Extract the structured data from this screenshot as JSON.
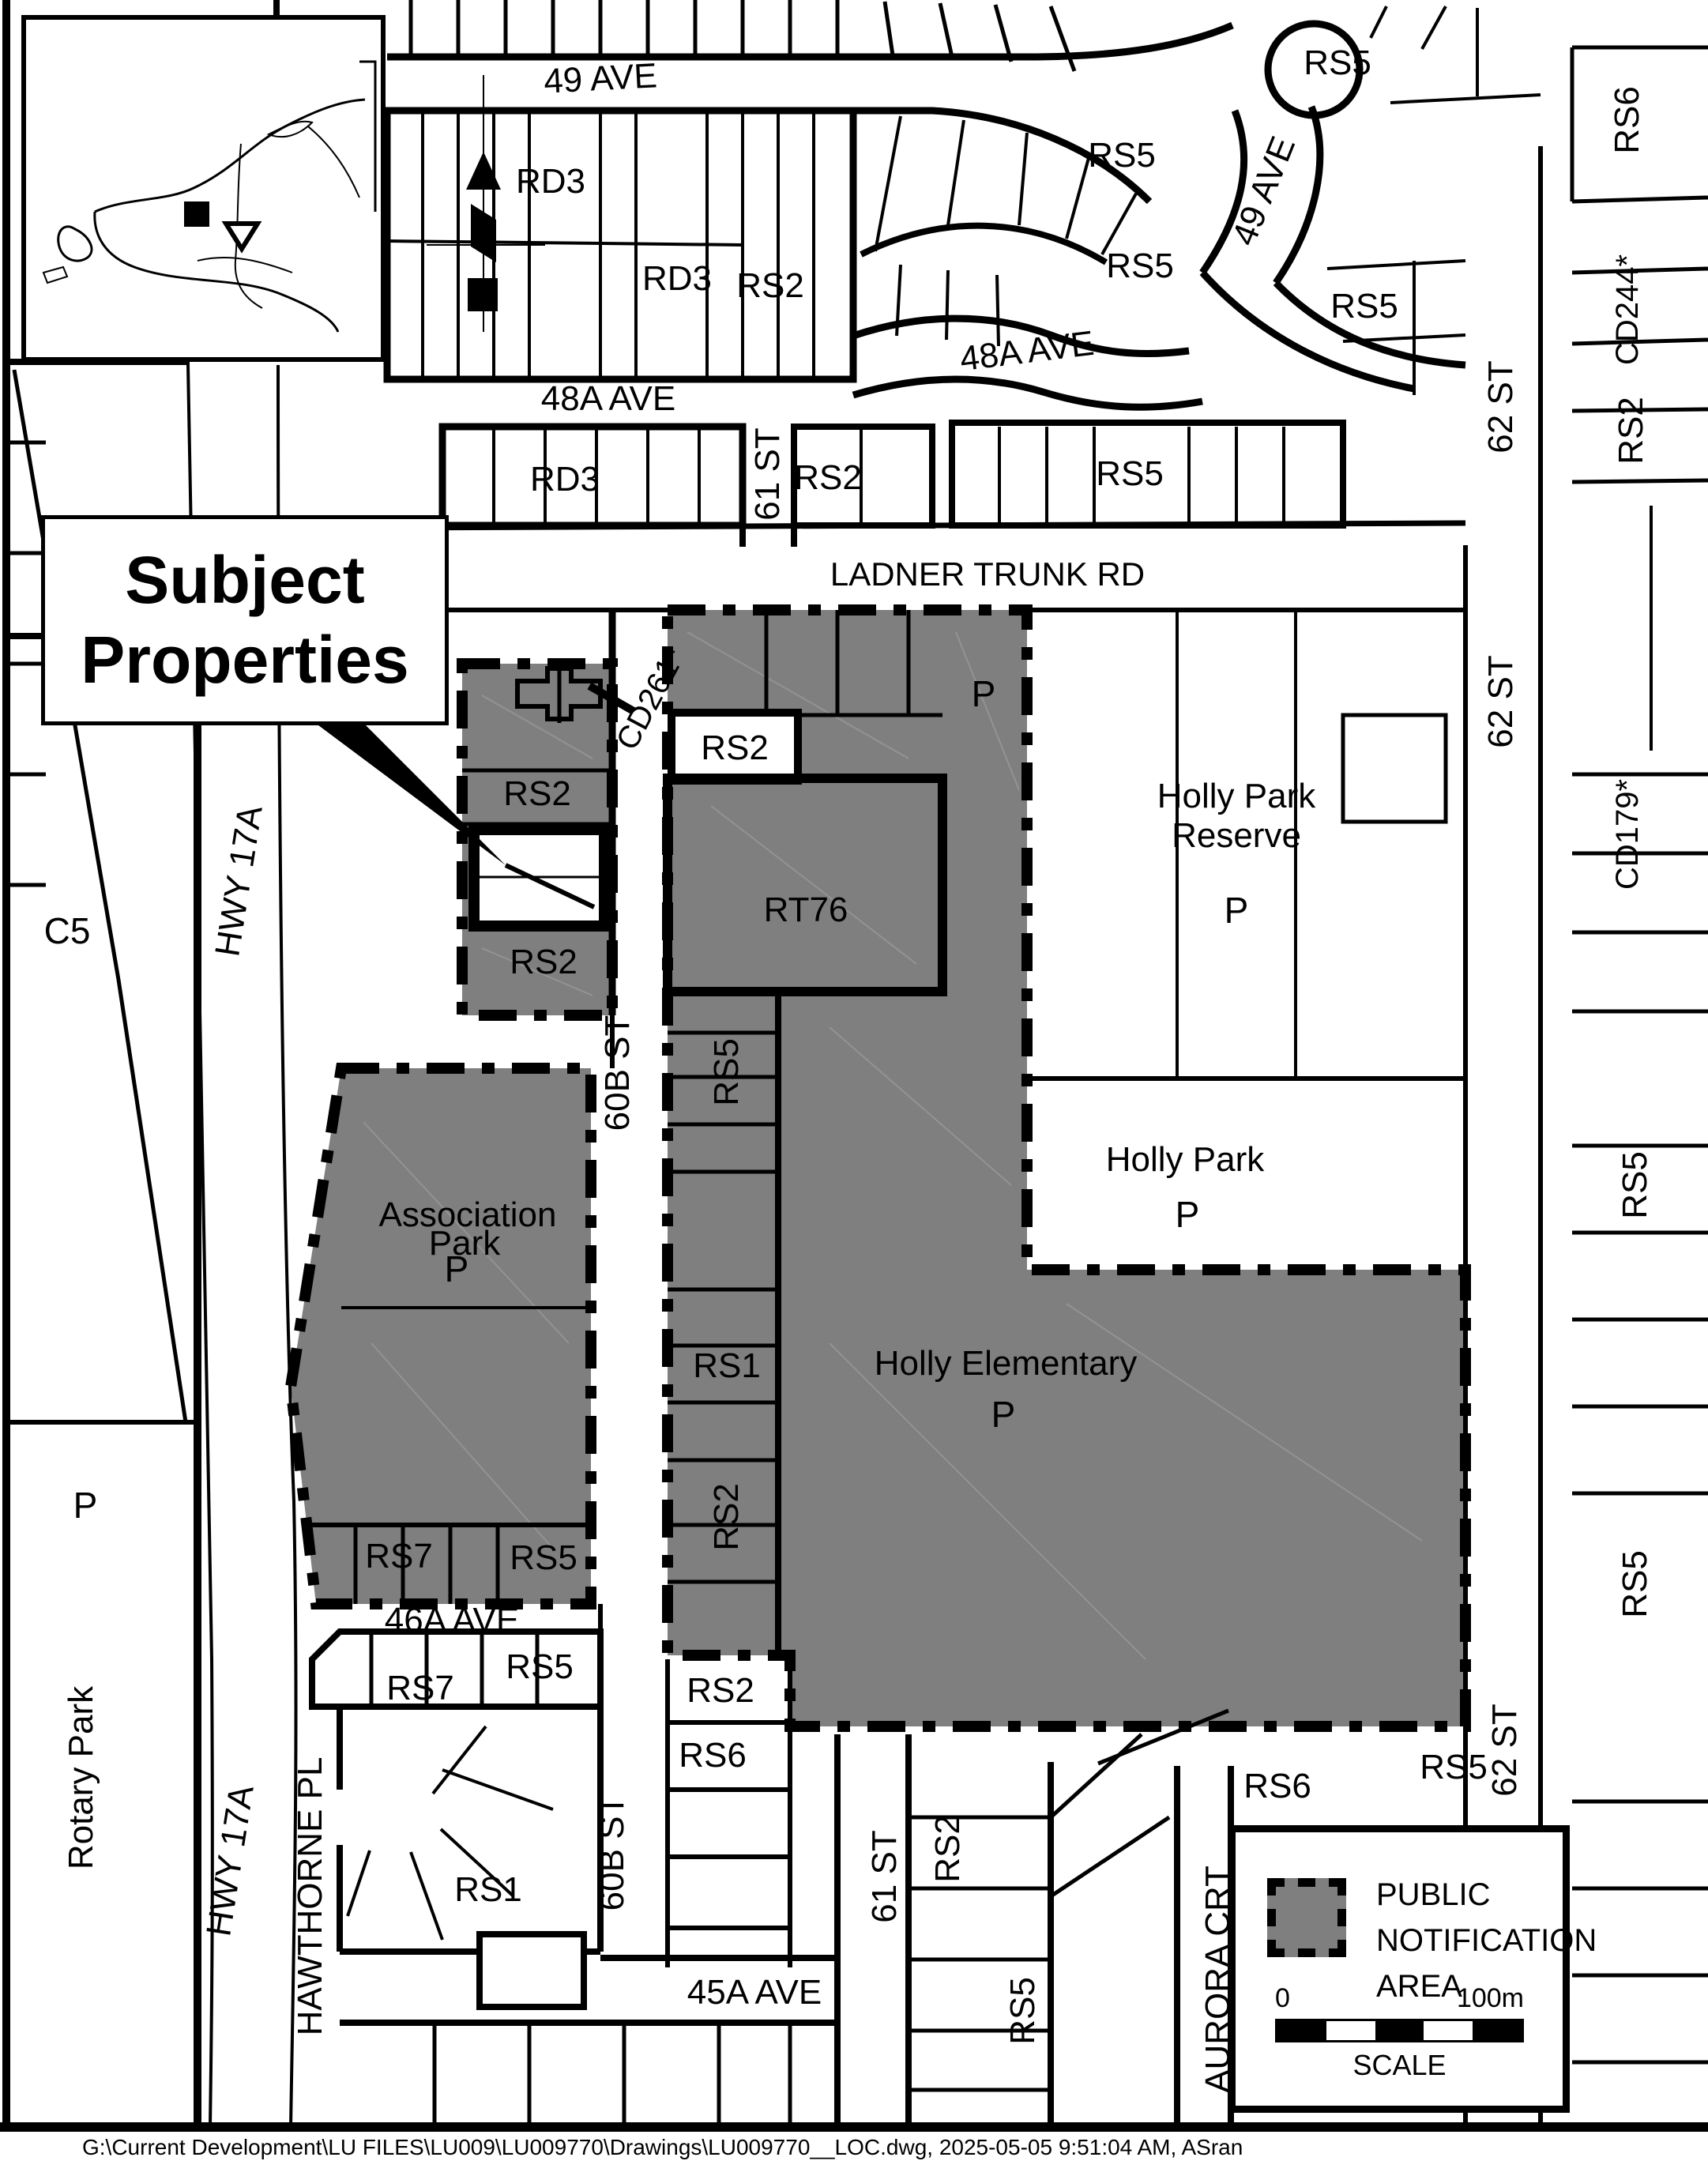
{
  "title_box": {
    "line1": "Subject",
    "line2": "Properties"
  },
  "streets": {
    "ave49": "49 AVE",
    "ave48a": "48A AVE",
    "ladner": "LADNER TRUNK RD",
    "st61": "61 ST",
    "st62": "62 ST",
    "st60b": "60B ST",
    "ave46a": "46A AVE",
    "hawthorne": "HAWTHORNE PL",
    "ave45a": "45A AVE",
    "aurora": "AURORA CRT",
    "hwy17a": "HWY 17A"
  },
  "zones": {
    "rd3": "RD3",
    "rs1": "RS1",
    "rs2": "RS2",
    "rs5": "RS5",
    "rs6": "RS6",
    "rs7": "RS7",
    "rt76": "RT76",
    "c5": "C5",
    "p": "P",
    "cd244": "CD244*",
    "cd179": "CD179*",
    "cd261": "CD261*"
  },
  "parks": {
    "holly_park_reserve_1": "Holly Park",
    "holly_park_reserve_2": "Reserve",
    "holly_park": "Holly Park",
    "holly_elementary": "Holly Elementary",
    "association_1": "Association",
    "association_2": "Park",
    "rotary": "Rotary Park"
  },
  "legend": {
    "title_line1": "PUBLIC",
    "title_line2": "NOTIFICATION",
    "title_line3": "AREA",
    "scale_start": "0",
    "scale_end": "100m",
    "scale_caption": "SCALE"
  },
  "footer": {
    "path": "G:\\Current Development\\LU FILES\\LU009\\LU009770\\Drawings\\LU009770__LOC.dwg, 2025-05-05 9:51:04 AM, ASran"
  },
  "colors": {
    "notification_gray": "#7f7f7f",
    "line": "#000000",
    "background": "#ffffff"
  }
}
